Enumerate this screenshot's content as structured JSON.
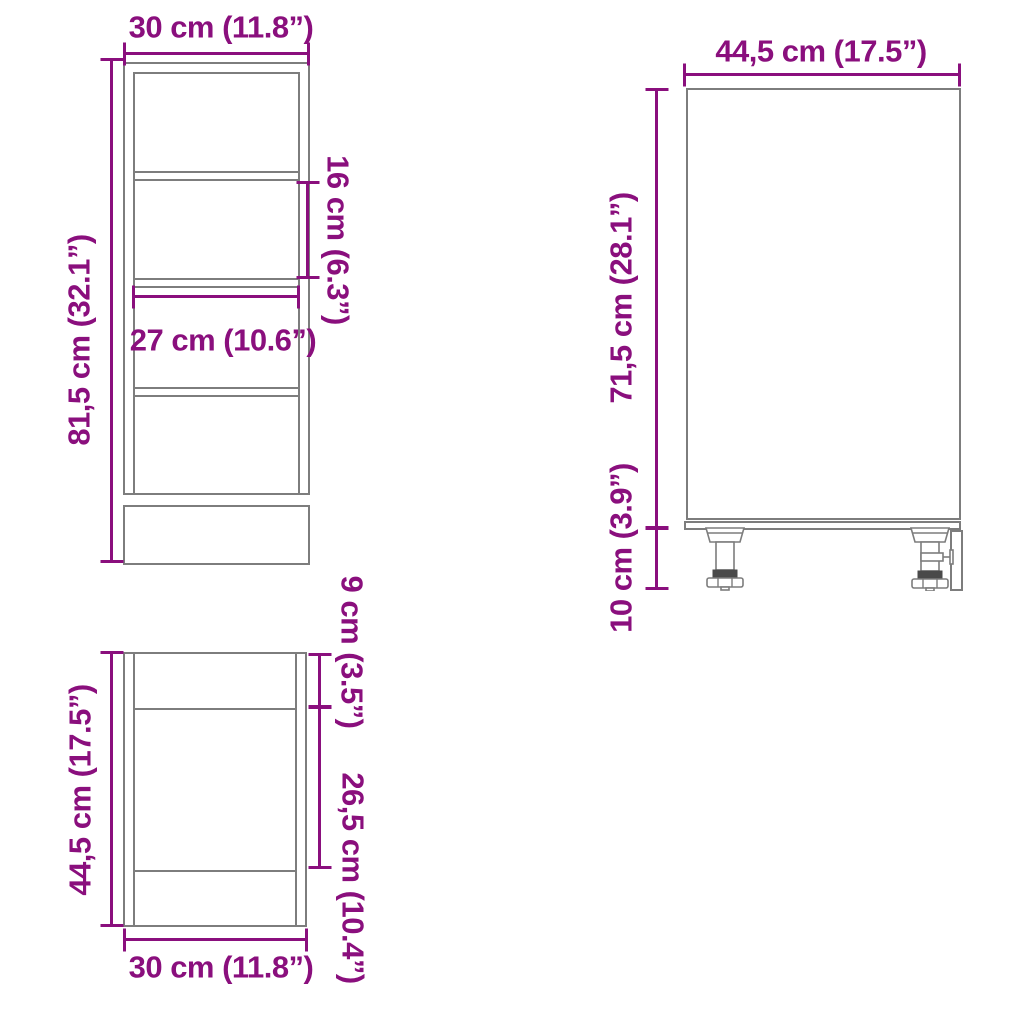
{
  "colors": {
    "dimension": "#8A0F7D",
    "outline": "#7d7d7d"
  },
  "front_view": {
    "width": "30 cm (11.8”)",
    "height": "81,5 cm (32.1”)",
    "shelf_spacing": "16 cm (6.3”)",
    "interior_width": "27 cm (10.6”)"
  },
  "top_view": {
    "depth": "44,5 cm (17.5”)",
    "width": "30 cm (11.8”)",
    "front_section": "9 cm (3.5”)",
    "middle_section": "26,5 cm (10.4”)"
  },
  "side_view": {
    "depth": "44,5 cm (17.5”)",
    "body_height": "71,5 cm (28.1”)",
    "leg_height": "10 cm (3.9”)"
  }
}
